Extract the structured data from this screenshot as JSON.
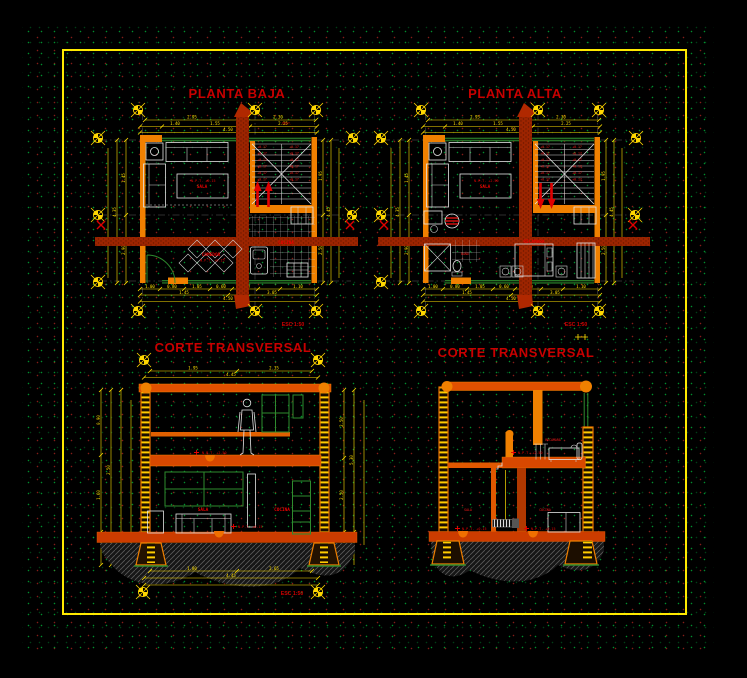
{
  "colors": {
    "background": "#000000",
    "frame": "#ffe900",
    "dimension": "#ffe000",
    "wall_orange": "#f08000",
    "cut_wall_red": "#9c2400",
    "slab": "#e05000",
    "window_green": "#2e8b2e",
    "furniture_white": "#e4e4e4",
    "label_red": "#e80000",
    "title_red": "#c80000"
  },
  "planta_baja": {
    "title": "PLANTA BAJA",
    "scale_label": "ESC 1:50",
    "rooms": {
      "sala": "SALA",
      "sala_level": "N.P.T. +0.15",
      "comedor": "COMEDOR",
      "comedor_level": "N.P.T. +0.15",
      "cocina": "COCINA"
    },
    "stair_step_label": "+0.17",
    "proy_label": "PROY.",
    "dims_top": [
      "2.95",
      "2.30",
      "1.40",
      "1.55",
      "2.25",
      "4.50"
    ],
    "dims_left": [
      "1.45",
      "2.90",
      "4.35"
    ],
    "dims_right": [
      "1.95",
      "2.50",
      "4.45"
    ],
    "dims_bottom": [
      "1.00",
      "0.80",
      "1.05",
      "0.60",
      "1.00",
      "1.10",
      "1.45",
      "3.05",
      "4.50"
    ]
  },
  "planta_alta": {
    "title": "PLANTA ALTA",
    "scale_label": "ESC 1:50",
    "rooms": {
      "sala": "SALA",
      "sala_level": "N.P.T. +2.50",
      "bano": "BAÑO",
      "recamara": "RECAMARA"
    },
    "stair_step_label": "+0.17",
    "dims_top": [
      "2.95",
      "2.30",
      "1.40",
      "1.55",
      "2.25",
      "4.50"
    ],
    "dims_left": [
      "1.45",
      "2.90",
      "4.35"
    ],
    "dims_right": [
      "1.95",
      "2.50",
      "4.45"
    ],
    "dims_bottom": [
      "1.00",
      "0.80",
      "1.05",
      "0.60",
      "1.00",
      "1.10",
      "1.45",
      "3.05",
      "4.50"
    ]
  },
  "corte_izquierdo": {
    "title": "CORTE TRANSVERSAL",
    "scale_label": "ESC 1:50",
    "labels": {
      "nivel_alto": "N.P.T. +2.50",
      "sala": "SALA",
      "cocina": "COCINA",
      "nivel_bajo": "N.P.T. +0.15"
    },
    "dims_top": [
      "1.95",
      "2.35",
      "4.45"
    ],
    "dims_left": [
      "0.90",
      "1.60",
      "2.50"
    ],
    "dims_right": [
      "2.50",
      "2.50",
      "5.30"
    ],
    "dims_bottom": [
      "1.80",
      "2.65",
      "4.45"
    ]
  },
  "corte_derecho": {
    "title": "CORTE TRANSVERSAL",
    "labels": {
      "recamara": "RECAMARA",
      "nivel_alto": "N.P.T. +2.50",
      "sala": "SALA",
      "cocina": "COCINA",
      "nivel_sala": "N.P.T. +0.15",
      "nivel_cocina": "N.P.T. +0.15"
    }
  }
}
